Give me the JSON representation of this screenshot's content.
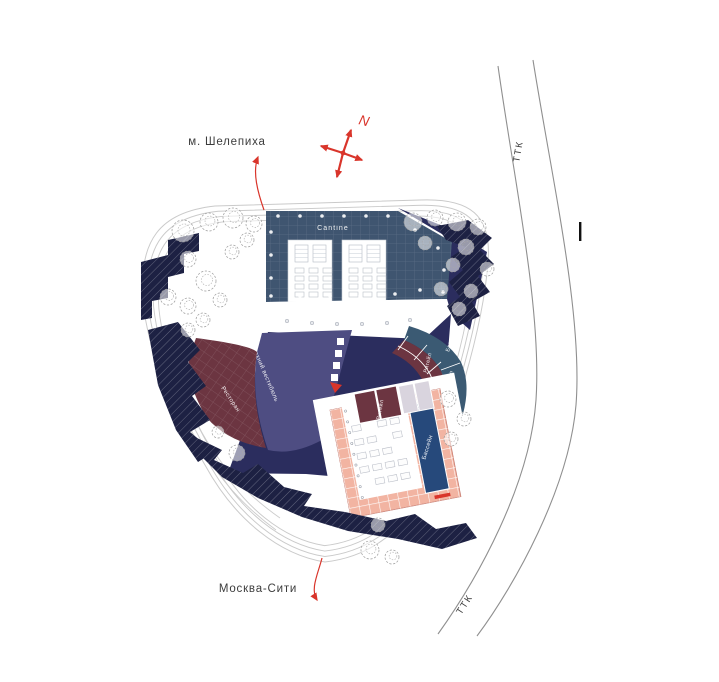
{
  "annotations": {
    "metro_station": "м. Шелепиха",
    "moscow_city": "Москва-Сити",
    "ring_road": "ТТК",
    "north_mark": "N"
  },
  "zones": {
    "cantine": "Cantine",
    "upper_vestibule": "Верхний вестибюль",
    "restaurant": "Ресторан",
    "plaza": "Площадка",
    "retail": "Ритейл",
    "bar": "Бар",
    "pool": "Бассейн"
  },
  "colors": {
    "red_accent": "#d9352b",
    "roof_blue": "#3f5570",
    "plaza_navy": "#2b2d5e",
    "vestibule_purple": "#4e4d82",
    "wine_red": "#6c3541",
    "teal_blue": "#3b5a73",
    "terrace_dark": "#1d2143",
    "pool_blue": "#26497b",
    "tile_pink": "#f2b4a2",
    "retail_light": "#d9d4de"
  }
}
